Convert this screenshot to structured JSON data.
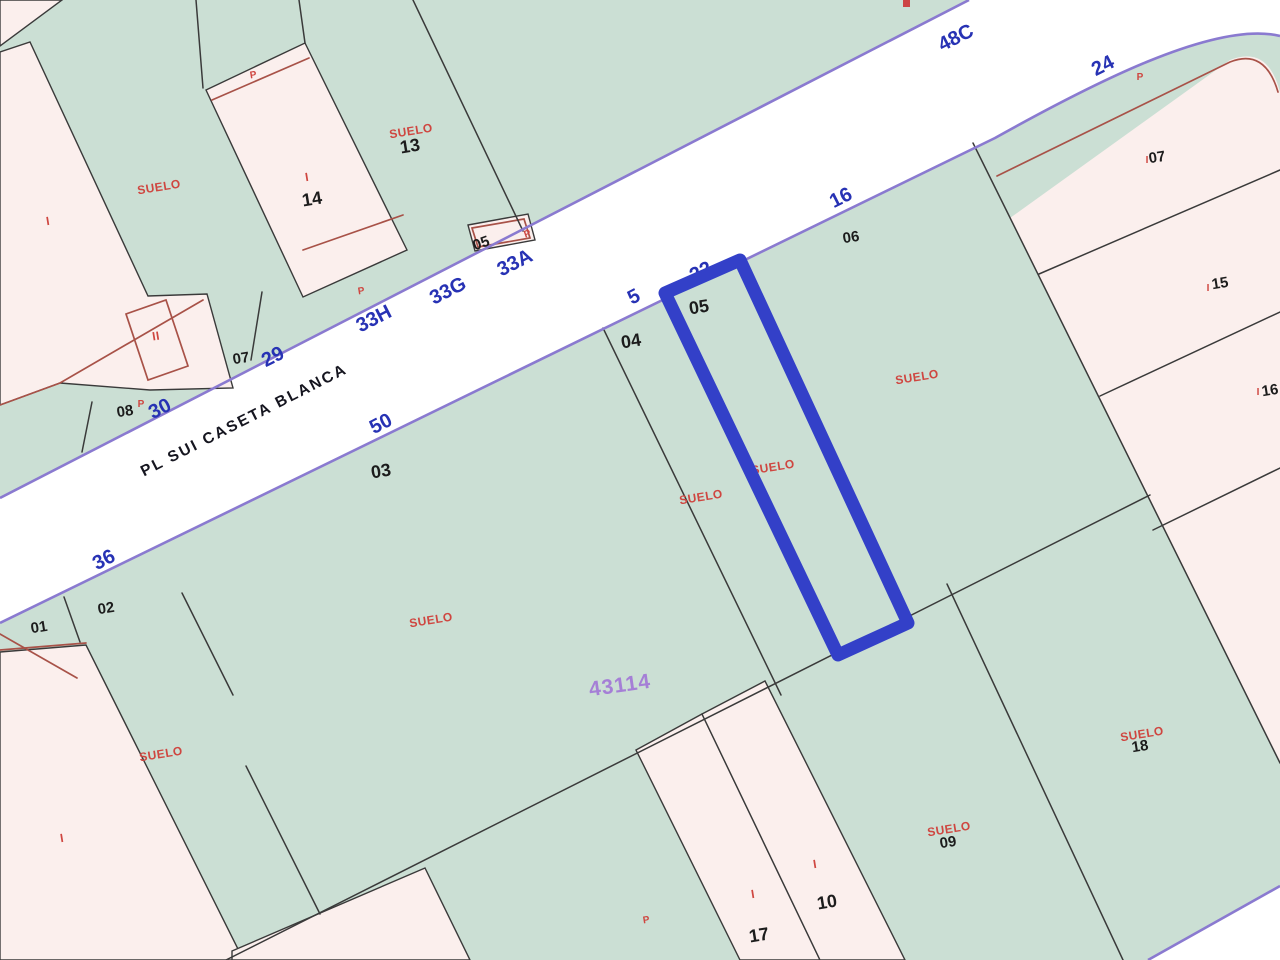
{
  "road": {
    "street_name": "PL SUI CASETA BLANCA",
    "portals": [
      "36",
      "30",
      "29",
      "33H",
      "33G",
      "33A",
      "50",
      "5",
      "22",
      "16",
      "48C",
      "24"
    ]
  },
  "block": {
    "number": "43114"
  },
  "parcels": {
    "numbers": [
      "01",
      "02",
      "03",
      "04",
      "05",
      "06",
      "07",
      "08",
      "13",
      "14",
      "05",
      "07",
      "15",
      "16",
      "17",
      "18",
      "09",
      "10"
    ]
  },
  "land_use": {
    "label": "SUELO"
  },
  "marks": {
    "i": "I",
    "ii": "II",
    "p": "P"
  },
  "selection": {
    "highlighted_parcel": "05"
  },
  "colors": {
    "parcel_green": "#cbdfd4",
    "parcel_pink": "#fbefed",
    "road_white": "#ffffff",
    "road_edge_purple": "#8a7ad0",
    "boundary_dark": "#3a3a3a",
    "inner_boundary_red": "#a85248",
    "highlight_blue": "#3340c8",
    "label_red": "#cf4640",
    "label_blue": "#2732b4",
    "label_black": "#1c1c1c",
    "label_purple": "#a57fd6"
  }
}
